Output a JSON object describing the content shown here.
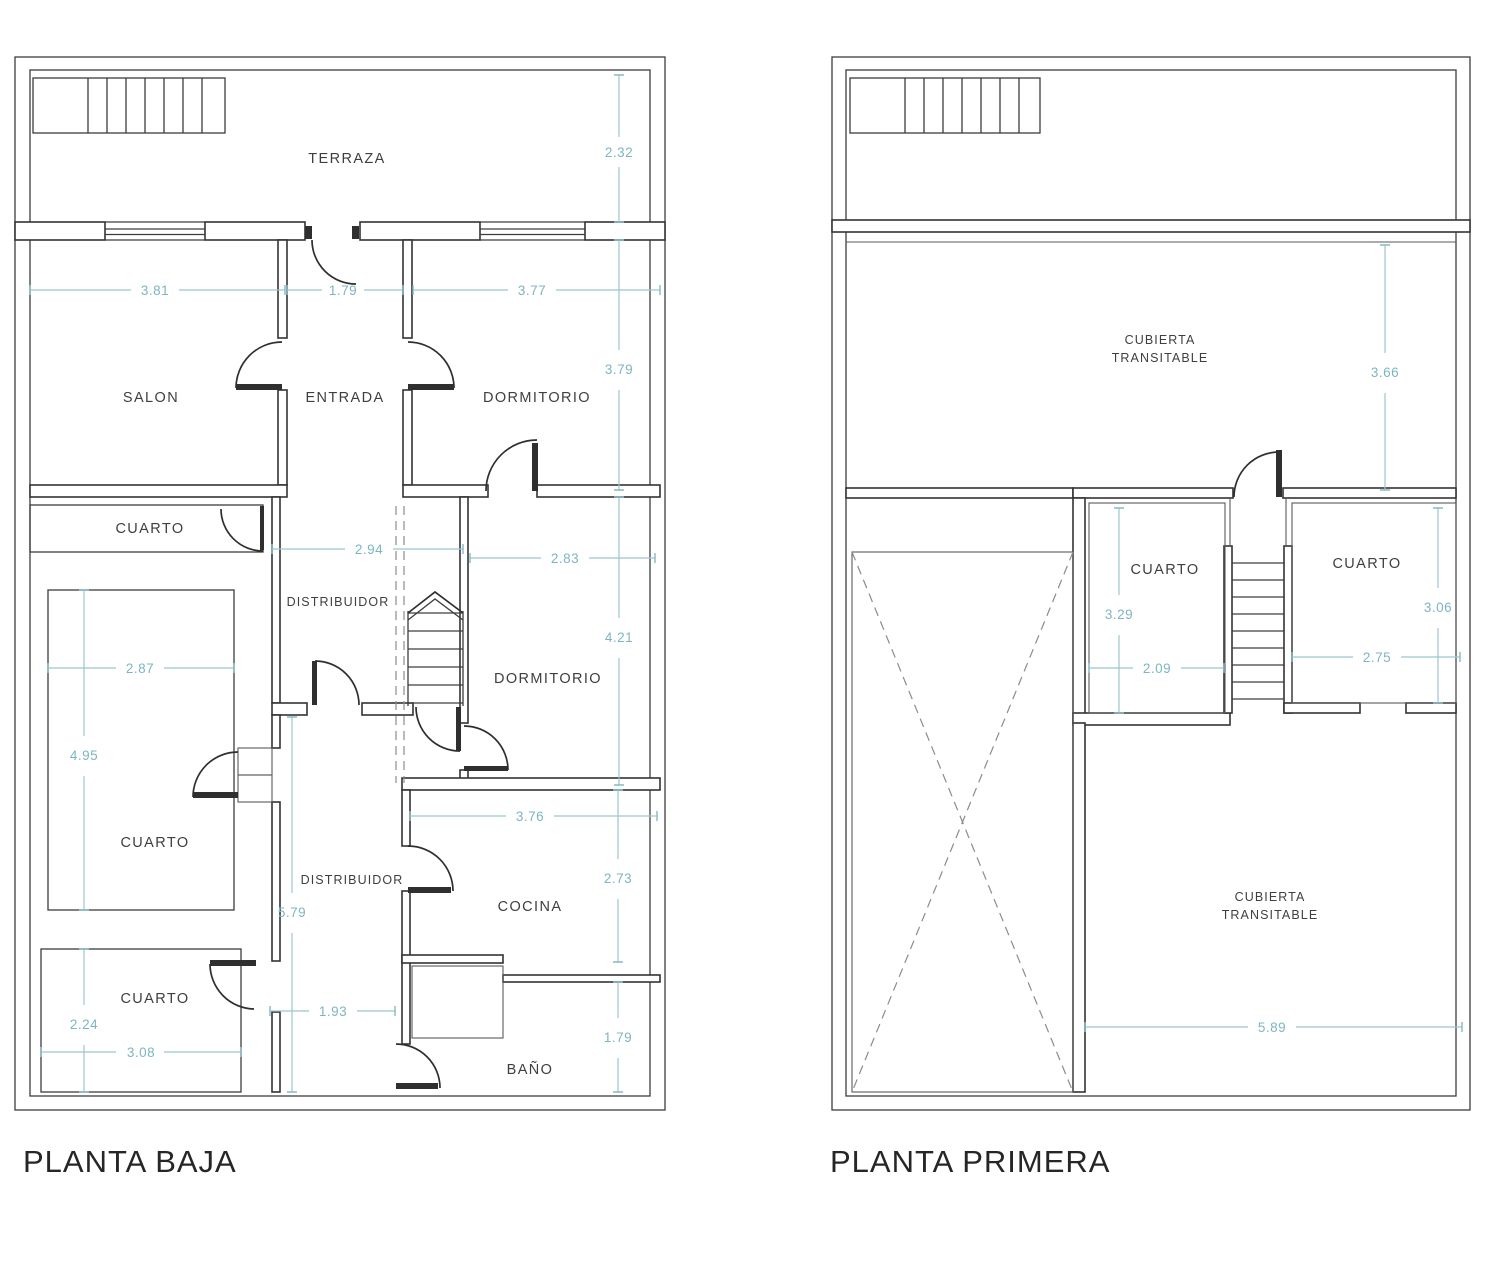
{
  "document": {
    "type": "architectural-floor-plan",
    "units": "m",
    "background": "#ffffff"
  },
  "colors": {
    "wall": "#333333",
    "dimension": "#7db6c1",
    "dashed": "#8c8c8c",
    "label": "#3f3f3f",
    "title": "#262626"
  },
  "plans": {
    "baja": {
      "title": "PLANTA BAJA",
      "rooms": {
        "terraza": "TERRAZA",
        "salon": "SALON",
        "entrada": "ENTRADA",
        "dormitorio1": "DORMITORIO",
        "cuarto_strip": "CUARTO",
        "distribuidor1": "DISTRIBUIDOR",
        "dormitorio2": "DORMITORIO",
        "cuarto_big": "CUARTO",
        "distribuidor2": "DISTRIBUIDOR",
        "cocina": "COCINA",
        "cuarto_small": "CUARTO",
        "bano": "BAÑO"
      },
      "dims": {
        "terraza_h": "2.32",
        "salon_w": "3.81",
        "entrada_w": "1.79",
        "dorm1_w": "3.77",
        "dorm1_h": "3.79",
        "distr1_w": "2.94",
        "dorm2_w": "2.83",
        "dorm2_h": "4.21",
        "cuarto_big_w": "2.87",
        "cuarto_big_h": "4.95",
        "distr2_h": "5.79",
        "cocina_w": "3.76",
        "cocina_h": "2.73",
        "pasillo_w": "1.93",
        "cuarto_small_h": "2.24",
        "cuarto_small_w": "3.08",
        "bano_h": "1.79"
      }
    },
    "primera": {
      "title": "PLANTA PRIMERA",
      "rooms": {
        "cubierta_top_l1": "CUBIERTA",
        "cubierta_top_l2": "TRANSITABLE",
        "cuarto_left": "CUARTO",
        "cuarto_right": "CUARTO",
        "cubierta_bottom_l1": "CUBIERTA",
        "cubierta_bottom_l2": "TRANSITABLE"
      },
      "dims": {
        "cubierta_top_h": "3.66",
        "cuarto_left_h": "3.29",
        "cuarto_left_w": "2.09",
        "cuarto_right_h": "3.06",
        "cuarto_right_w": "2.75",
        "cubierta_bottom_w": "5.89"
      }
    }
  }
}
